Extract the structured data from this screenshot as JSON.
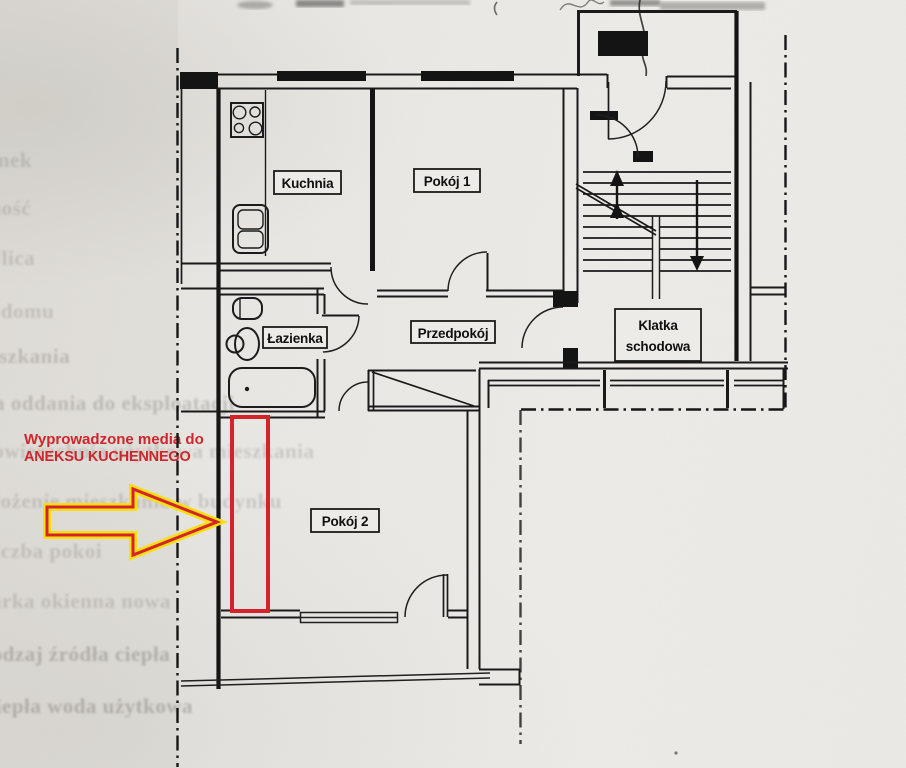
{
  "plan": {
    "room_labels": {
      "kitchen": "Kuchnia",
      "room1": "Pokój 1",
      "bathroom": "Łazienka",
      "hall": "Przedpokój",
      "staircase_line1": "Klatka",
      "staircase_line2": "schodowa",
      "room2": "Pokój 2"
    }
  },
  "annotation": {
    "text_line1": "Wyprowadzone media do",
    "text_line2": "ANEKSU KUCHENNEGO",
    "text_color": "#d0232b",
    "arrow_color": "#d4232a",
    "arrow_outline_color": "#f7df12",
    "highlight_color": "#d4232a"
  },
  "ghost_text": {
    "rows": [
      {
        "text": "Budynek"
      },
      {
        "text": "Własność"
      },
      {
        "text": "Ulica"
      },
      {
        "text": "Nr domu"
      },
      {
        "text": "Nr mieszkania"
      },
      {
        "text": "Data oddania do eksploatacji"
      },
      {
        "text": "Powierzchnia użytkowa mieszkania"
      },
      {
        "text": "Położenie mieszkania w budynku"
      },
      {
        "text": "Liczba pokoi"
      },
      {
        "text": "Stolarka okienna nowa"
      },
      {
        "text": "Rodzaj źródła ciepła"
      },
      {
        "text": "Ciepła woda użytkowa"
      }
    ]
  },
  "colors": {
    "paper": "#e9e7e3",
    "ink": "#1a1a1a",
    "boundary_ink": "#161616"
  }
}
